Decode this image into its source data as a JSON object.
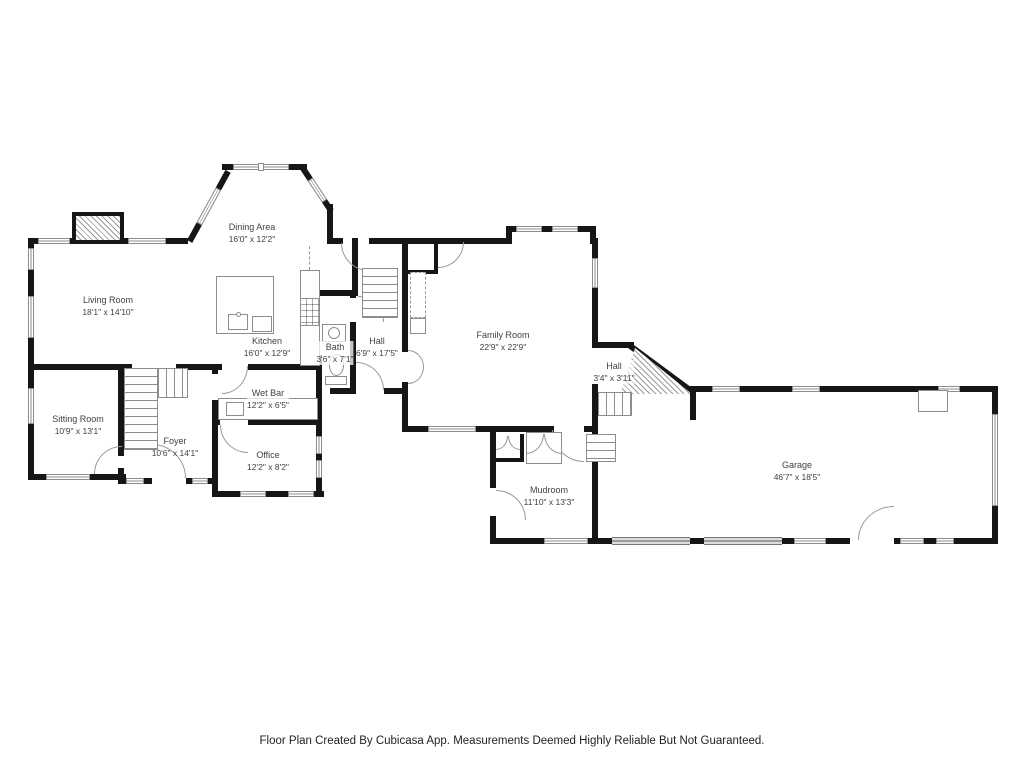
{
  "footer": {
    "text": "Floor Plan Created By Cubicasa App. Measurements Deemed Highly Reliable But Not Guaranteed."
  },
  "colors": {
    "wall": "#161616",
    "fixture_line": "#8d8d8d",
    "label_text": "#3d4247"
  },
  "rooms": {
    "dining_area": {
      "name": "Dining Area",
      "dims": "16'0\" x 12'2\""
    },
    "living_room": {
      "name": "Living Room",
      "dims": "18'1\" x 14'10\""
    },
    "kitchen": {
      "name": "Kitchen",
      "dims": "16'0\" x 12'9\""
    },
    "bath": {
      "name": "Bath",
      "dims": "3'6\" x 7'1\""
    },
    "hall": {
      "name": "Hall",
      "dims": "6'9\" x 17'5\""
    },
    "family_room": {
      "name": "Family Room",
      "dims": "22'9\" x 22'9\""
    },
    "hall_small": {
      "name": "Hall",
      "dims": "3'4\" x 3'11\""
    },
    "sitting_room": {
      "name": "Sitting Room",
      "dims": "10'9\" x 13'1\""
    },
    "foyer": {
      "name": "Foyer",
      "dims": "10'6\" x 14'1\""
    },
    "wet_bar": {
      "name": "Wet Bar",
      "dims": "12'2\" x 6'5\""
    },
    "office": {
      "name": "Office",
      "dims": "12'2\" x 8'2\""
    },
    "mudroom": {
      "name": "Mudroom",
      "dims": "11'10\" x 13'3\""
    },
    "garage": {
      "name": "Garage",
      "dims": "46'7\" x 18'5\""
    }
  }
}
